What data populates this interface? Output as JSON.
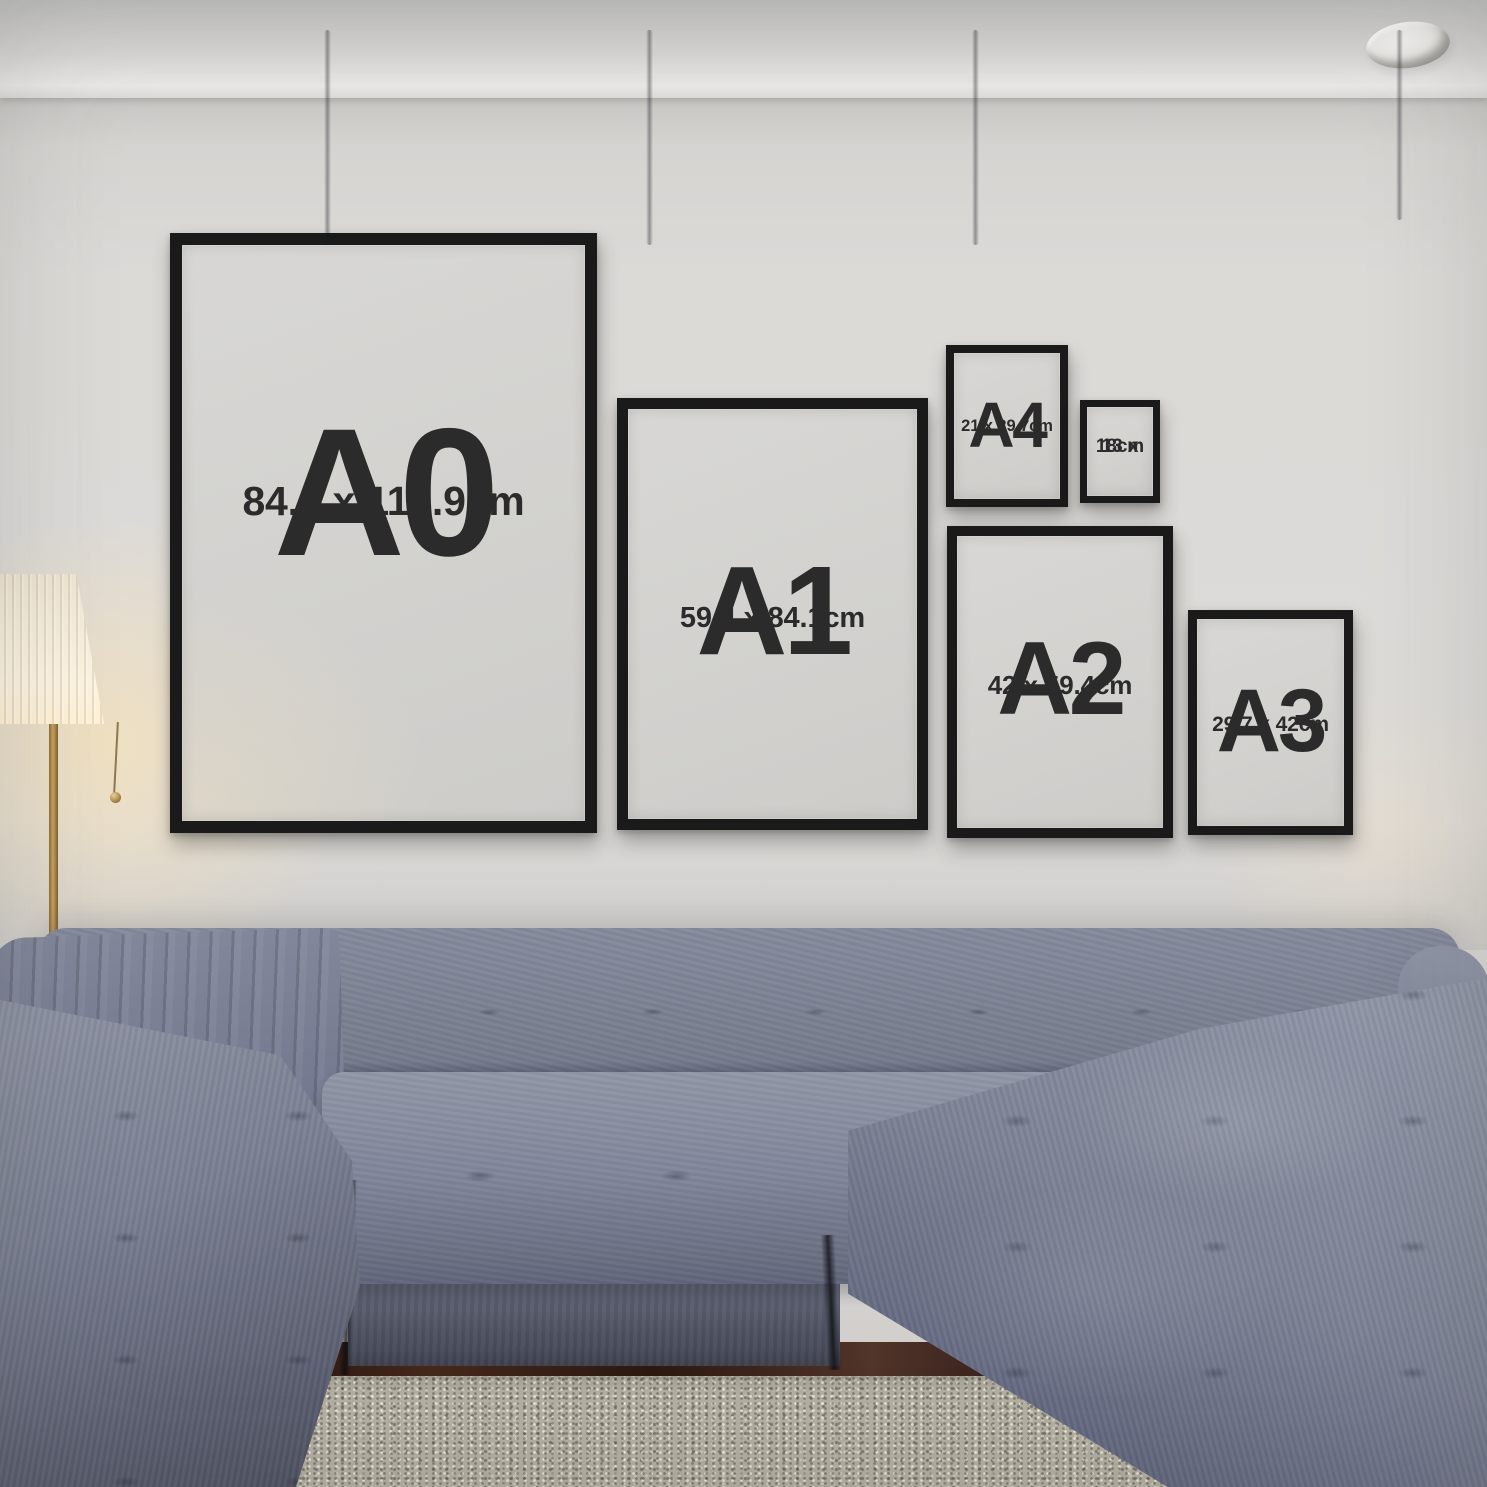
{
  "frames": [
    {
      "name": "A0",
      "label": "A0",
      "size": "84.1 x 118.9cm"
    },
    {
      "name": "A1",
      "label": "A1",
      "size": "59.4 x 84.1cm"
    },
    {
      "name": "A4",
      "label": "A4",
      "size": "21 x 29.7cm"
    },
    {
      "name": "13x18",
      "label": "13 x",
      "size": "18cm"
    },
    {
      "name": "A2",
      "label": "A2",
      "size": "42 x 59.4cm"
    },
    {
      "name": "A3",
      "label": "A3",
      "size": "29.7 x 42cm"
    }
  ],
  "colors": {
    "wall": "#dad8d4",
    "frame_border": "#1a1a1a",
    "frame_mat": "#d2d1ce",
    "label_text": "#2b2b2b",
    "sofa": "#767b8d",
    "rug": "#b5b0a4",
    "floor": "#3a2217",
    "lamp_glow": "rgba(255,228,175,0.55)"
  }
}
